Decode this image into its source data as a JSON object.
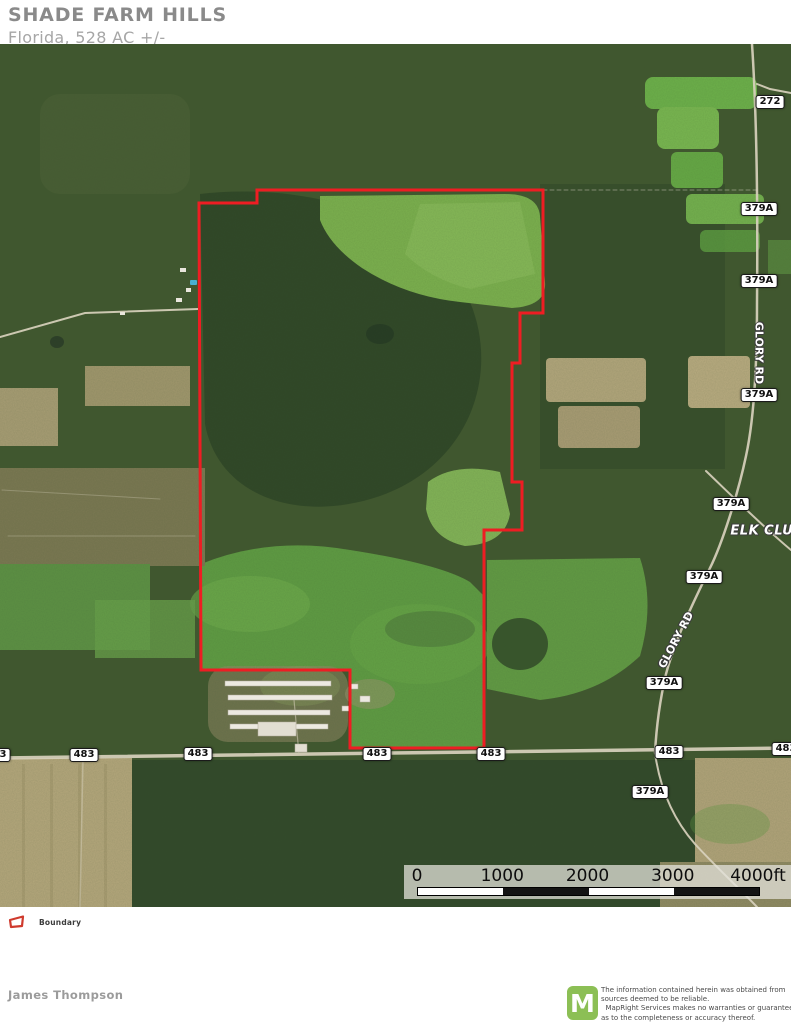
{
  "header": {
    "title": "SHADE FARM HILLS",
    "subtitle": "Florida, 528 AC +/-"
  },
  "map": {
    "boundary": {
      "color": "#ee1d23",
      "points": "199,159 257,159 257,146 543,146 543,269 520,269 520,319 512,319 512,438 522,438 522,486 484,486 484,704 350,704 350,626 201,626"
    },
    "shields": [
      {
        "label": "272",
        "x": 770,
        "y": 58
      },
      {
        "label": "379A",
        "x": 759,
        "y": 165
      },
      {
        "label": "379A",
        "x": 759,
        "y": 237
      },
      {
        "label": "379A",
        "x": 759,
        "y": 351
      },
      {
        "label": "379A",
        "x": 731,
        "y": 460
      },
      {
        "label": "379A",
        "x": 704,
        "y": 533
      },
      {
        "label": "379A",
        "x": 664,
        "y": 639
      },
      {
        "label": "379A",
        "x": 650,
        "y": 748
      },
      {
        "label": "483",
        "x": -4,
        "y": 711
      },
      {
        "label": "483",
        "x": 84,
        "y": 711
      },
      {
        "label": "483",
        "x": 198,
        "y": 710
      },
      {
        "label": "483",
        "x": 377,
        "y": 710
      },
      {
        "label": "483",
        "x": 491,
        "y": 710
      },
      {
        "label": "483",
        "x": 669,
        "y": 708
      },
      {
        "label": "483",
        "x": 786,
        "y": 705
      }
    ],
    "road_labels": [
      {
        "text": "GLORY RD",
        "x": 759,
        "y": 309,
        "rotate": 90,
        "size": 11,
        "style": "plain"
      },
      {
        "text": "GLORY RD",
        "x": 676,
        "y": 596,
        "rotate": -62,
        "size": 11,
        "style": "plain"
      },
      {
        "text": "ELK CLUB L",
        "x": 774,
        "y": 487,
        "rotate": 0,
        "size": 13,
        "style": "italic"
      }
    ],
    "scalebar": {
      "ticks": [
        {
          "label": "0",
          "f": 0
        },
        {
          "label": "1000",
          "f": 0.25
        },
        {
          "label": "2000",
          "f": 0.5
        },
        {
          "label": "3000",
          "f": 0.75
        },
        {
          "label": "4000ft",
          "f": 1
        }
      ],
      "segment_colors": [
        "#ffffff",
        "#141414",
        "#ffffff",
        "#141414"
      ]
    }
  },
  "legend": {
    "items": [
      {
        "label": "Boundary",
        "color": "#cf3a2d"
      }
    ]
  },
  "footer": {
    "author": "James Thompson",
    "brand_letter": "M",
    "brand_color": "#8CBF55",
    "disclaimer": "The information contained herein was obtained from\nsources deemed to be reliable.\n  MapRight Services makes no warranties or guarantees\nas to the completeness or accuracy thereof."
  }
}
